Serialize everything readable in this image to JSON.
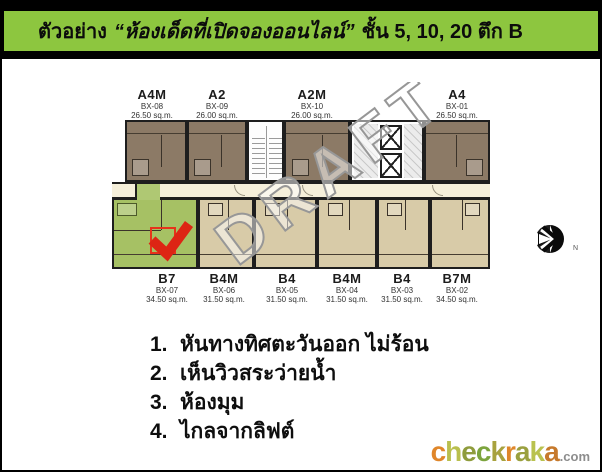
{
  "header": {
    "prefix": "ตัวอย่าง",
    "quoted": "“ห้องเด็ดที่เปิดจองออนไลน์”",
    "suffix": "ชั้น 5, 10, 20 ตึก B",
    "bg_color": "#8dc63f"
  },
  "plan": {
    "watermark": "DRAFT",
    "compass_label": "N",
    "top_units": [
      {
        "name": "A4M",
        "code": "BX-08",
        "area": "26.50 sq.m."
      },
      {
        "name": "A2",
        "code": "BX-09",
        "area": "26.00 sq.m."
      },
      {
        "name": "A2M",
        "code": "BX-10",
        "area": "26.00 sq.m."
      },
      {
        "name": "A4",
        "code": "BX-01",
        "area": "26.50 sq.m."
      }
    ],
    "bottom_units": [
      {
        "name": "B7",
        "code": "BX-07",
        "area": "34.50 sq.m.",
        "highlighted": true
      },
      {
        "name": "B4M",
        "code": "BX-06",
        "area": "31.50 sq.m.",
        "highlighted": false
      },
      {
        "name": "B4",
        "code": "BX-05",
        "area": "31.50 sq.m.",
        "highlighted": false
      },
      {
        "name": "B4M",
        "code": "BX-04",
        "area": "31.50 sq.m.",
        "highlighted": false
      },
      {
        "name": "B4",
        "code": "BX-03",
        "area": "31.50 sq.m.",
        "highlighted": false
      },
      {
        "name": "B7M",
        "code": "BX-02",
        "area": "34.50 sq.m.",
        "highlighted": false
      }
    ],
    "colors": {
      "top_unit": "#8c7a66",
      "bottom_unit": "#d8cba8",
      "highlight_unit": "#a6c164",
      "corridor": "#f5efda",
      "wall": "#1e1e1e",
      "check_red": "#dd2514"
    }
  },
  "features": {
    "items": [
      {
        "num": "1.",
        "text": "หันทางทิศตะวันออก ไม่ร้อน"
      },
      {
        "num": "2.",
        "text": "เห็นวิวสระว่ายน้ำ"
      },
      {
        "num": "3.",
        "text": "ห้องมุม"
      },
      {
        "num": "4.",
        "text": "ไกลจากลิฟต์"
      }
    ]
  },
  "logo": {
    "letters": [
      {
        "ch": "c",
        "color": "#e0862a"
      },
      {
        "ch": "h",
        "color": "#b9bf4e"
      },
      {
        "ch": "e",
        "color": "#8f9c3c"
      },
      {
        "ch": "c",
        "color": "#7ca43d"
      },
      {
        "ch": "k",
        "color": "#a8a23e"
      },
      {
        "ch": "r",
        "color": "#df862a"
      },
      {
        "ch": "a",
        "color": "#9aa03f"
      },
      {
        "ch": "k",
        "color": "#b9c24f"
      },
      {
        "ch": "a",
        "color": "#c6792c"
      }
    ],
    "suffix": ".com",
    "suffix_color": "#8d8d8d"
  }
}
